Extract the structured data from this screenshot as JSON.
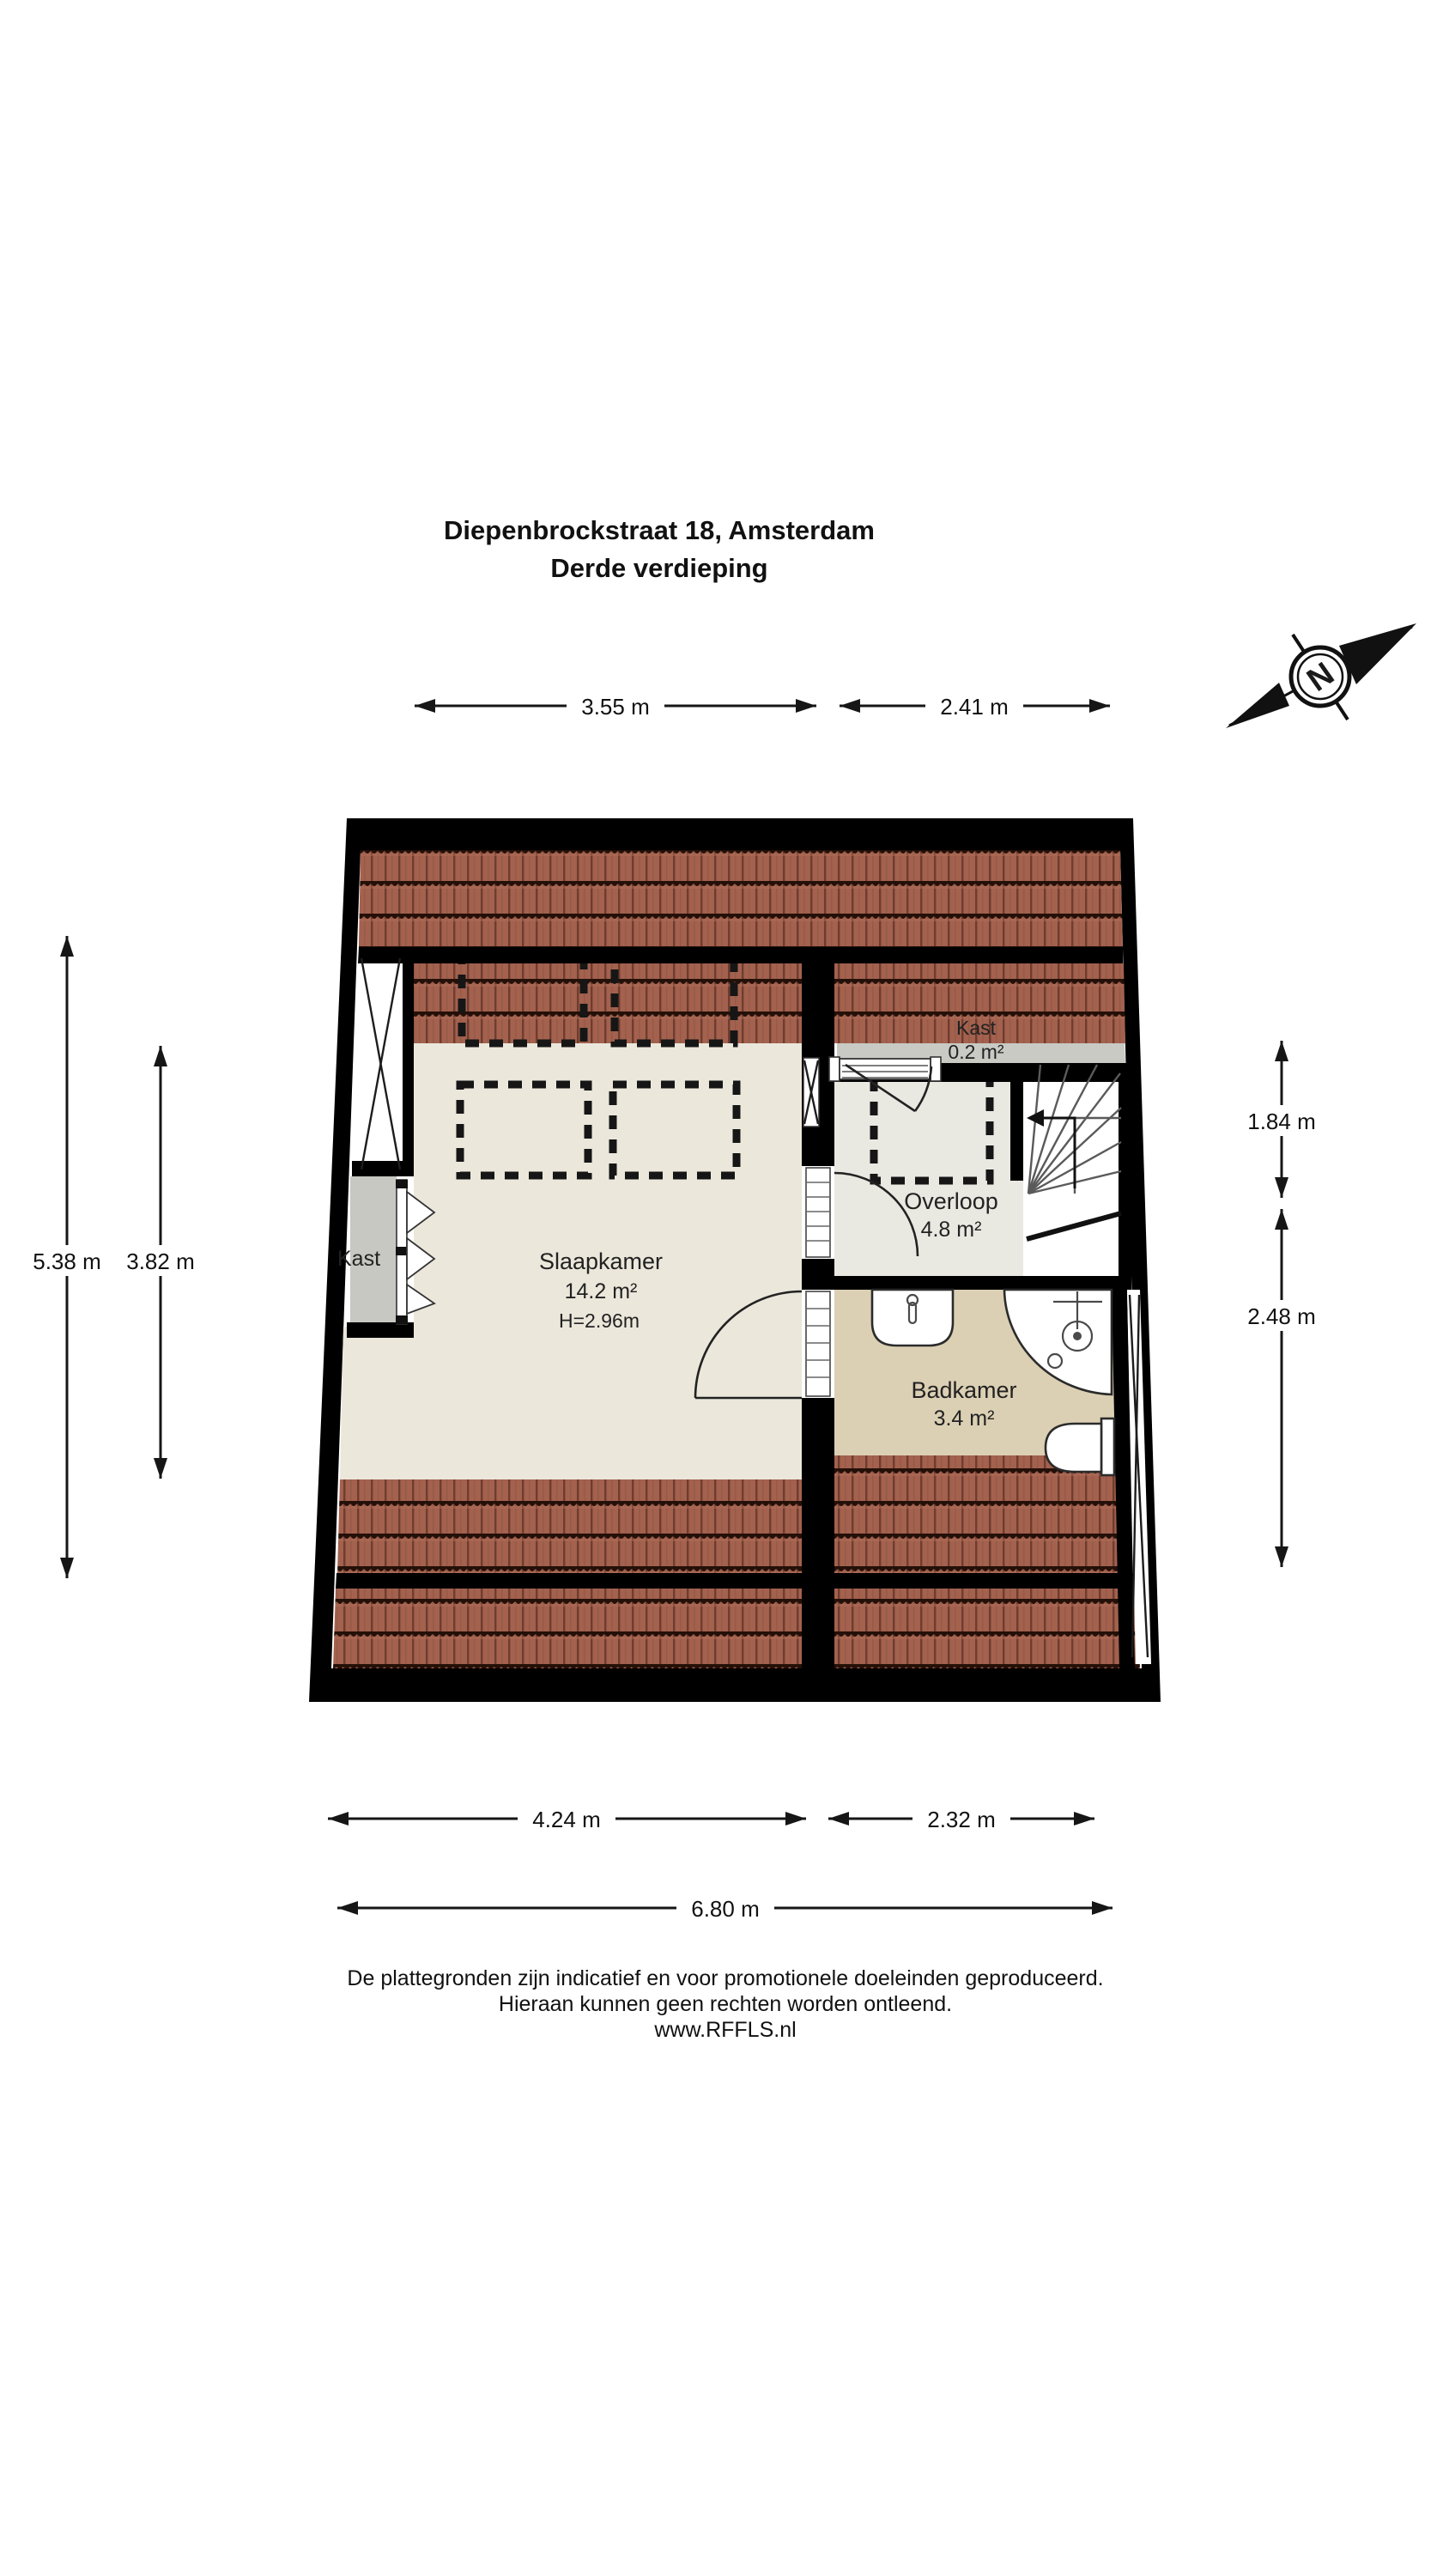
{
  "title": {
    "line1": "Diepenbrockstraat 18, Amsterdam",
    "line2": "Derde verdieping"
  },
  "compass": {
    "letter": "N"
  },
  "rooms": {
    "slaapkamer": {
      "name": "Slaapkamer",
      "area": "14.2 m²",
      "ceiling_height": "H=2.96m"
    },
    "kast_left": {
      "name": "Kast"
    },
    "kast_small": {
      "name": "Kast",
      "area": "0.2 m²"
    },
    "overloop": {
      "name": "Overloop",
      "area": "4.8 m²"
    },
    "badkamer": {
      "name": "Badkamer",
      "area": "3.4 m²"
    }
  },
  "dimensions": {
    "top": [
      {
        "label": "3.55 m"
      },
      {
        "label": "2.41 m"
      }
    ],
    "left": [
      {
        "label": "5.38 m"
      },
      {
        "label": "3.82 m"
      }
    ],
    "right": [
      {
        "label": "1.84 m"
      },
      {
        "label": "2.48 m"
      }
    ],
    "bottom": [
      {
        "label": "4.24 m"
      },
      {
        "label": "2.32 m"
      },
      {
        "label": "6.80 m"
      }
    ]
  },
  "footer": {
    "line1": "De plattegronden zijn indicatief en voor promotionele doeleinden geproduceerd.",
    "line2": "Hieraan kunnen geen rechten worden ontleend.",
    "line3": "www.RFFLS.nl"
  },
  "colors": {
    "wall": "#000000",
    "roof_tile": "#a3614e",
    "roof_tile_joint": "#6e3d2f",
    "roof_tile_wave": "#241008",
    "floor_main": "#ebe7db",
    "floor_overloop": "#e9e8e1",
    "floor_bathroom": "#dcd0b4",
    "closet_gray": "#c7c8c2",
    "kast_strip_gray": "#c9cac4"
  }
}
